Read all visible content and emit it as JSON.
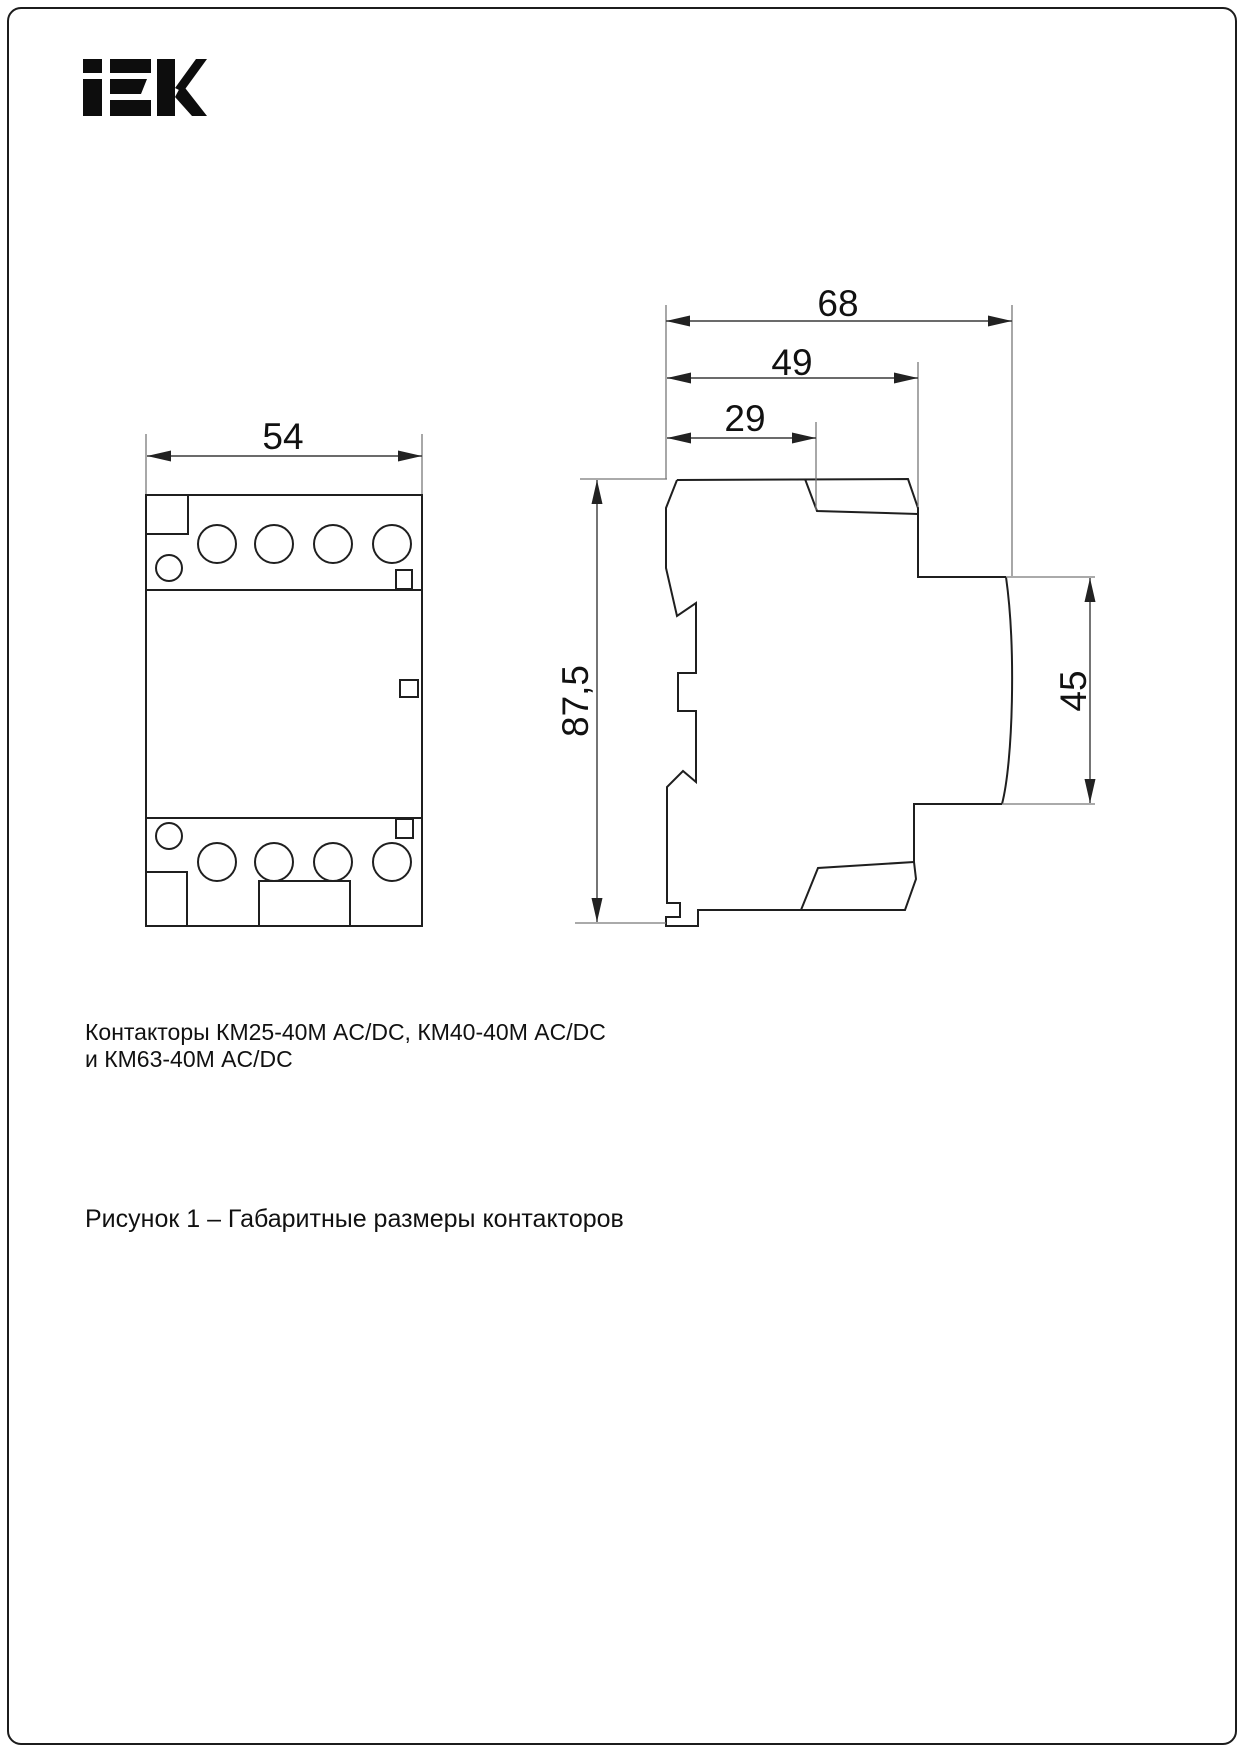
{
  "page": {
    "background": "#ffffff",
    "border_color": "#1c1c1c"
  },
  "logo": {
    "name": "IEK"
  },
  "front_view": {
    "width_label": "54"
  },
  "side_view": {
    "depth_total_label": "68",
    "depth_upper_label": "49",
    "depth_top_label": "29",
    "height_label": "87,5",
    "right_height_label": "45"
  },
  "captions": {
    "products_line1": "Контакторы КМ25-40М AC/DC, КМ40-40М AC/DC",
    "products_line2": "и КМ63-40М AC/DC",
    "figure": "Рисунок 1 – Габаритные размеры контакторов"
  },
  "colors": {
    "outline": "#1f1f1f",
    "dimension": "#3a3a3a",
    "extension": "#787878",
    "text": "#111111"
  }
}
